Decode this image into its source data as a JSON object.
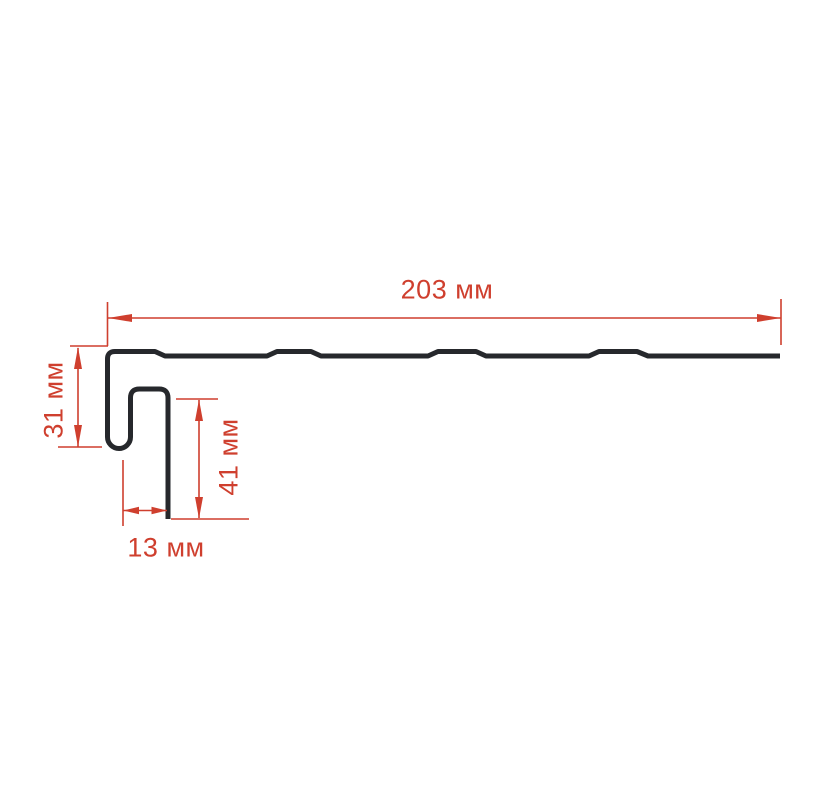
{
  "page": {
    "background": "#ffffff"
  },
  "colors": {
    "profile_stroke": "#26282c",
    "dimension_red": "#cf3f2e"
  },
  "diagram": {
    "type": "technical-profile-cross-section",
    "dimensions": {
      "top_width": {
        "value": 203,
        "unit": "мм",
        "label": "203 мм"
      },
      "left_height": {
        "value": 31,
        "unit": "мм",
        "label": "31 мм"
      },
      "inner_height": {
        "value": 41,
        "unit": "мм",
        "label": "41 мм"
      },
      "bottom_width": {
        "value": 13,
        "unit": "мм",
        "label": "13 мм"
      }
    }
  }
}
